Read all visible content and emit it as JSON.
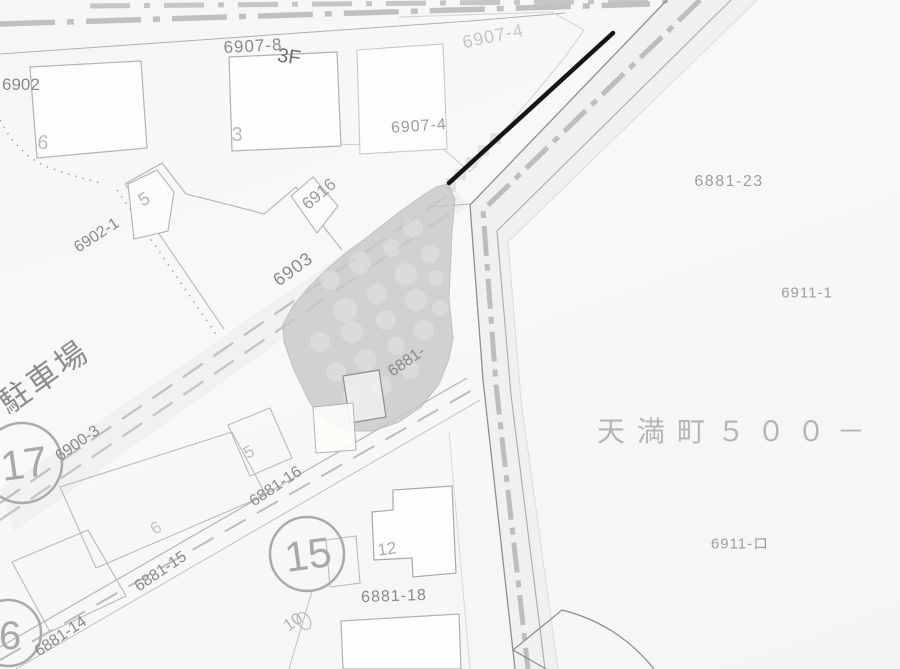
{
  "map": {
    "region_labels": {
      "address_block": "天満町５００－",
      "parking": "駐車場"
    },
    "parcel_numbers": {
      "p6907_8": "6907-8",
      "floor": "3F",
      "p6907_4_upper": "6907-4",
      "p6907_4_lower": "6907-4",
      "p690x": "6902",
      "p6902_1": "6902-1",
      "p6903": "6903",
      "p6916": "6916",
      "p6900_3": "6900-3",
      "p6881_23": "6881-23",
      "p6911_1": "6911-1",
      "p6911_ro": "6911-ロ",
      "p6881_16": "6881-16",
      "p6881_15": "6881-15",
      "p6881_14": "6881-14",
      "p6881_18": "6881-18",
      "p6881_sel": "6881-"
    },
    "building_numbers": {
      "b6_top": "6",
      "b3": "3",
      "b5_upper": "5",
      "b5_mid": "5",
      "b6_mid": "6",
      "b12": "12",
      "b10": "10"
    },
    "circled_numbers": {
      "c17": "17",
      "c15": "15",
      "c6": "6"
    },
    "colors": {
      "background": "#f7f7f5",
      "line": "#9a9a9a",
      "faint_line": "#c9c9c7",
      "label_text": "#8a8a8a",
      "selected_parcel_shade": "#c8c8c6",
      "highlight_line": "#151515",
      "road_marker": "#bdbdbd"
    }
  }
}
